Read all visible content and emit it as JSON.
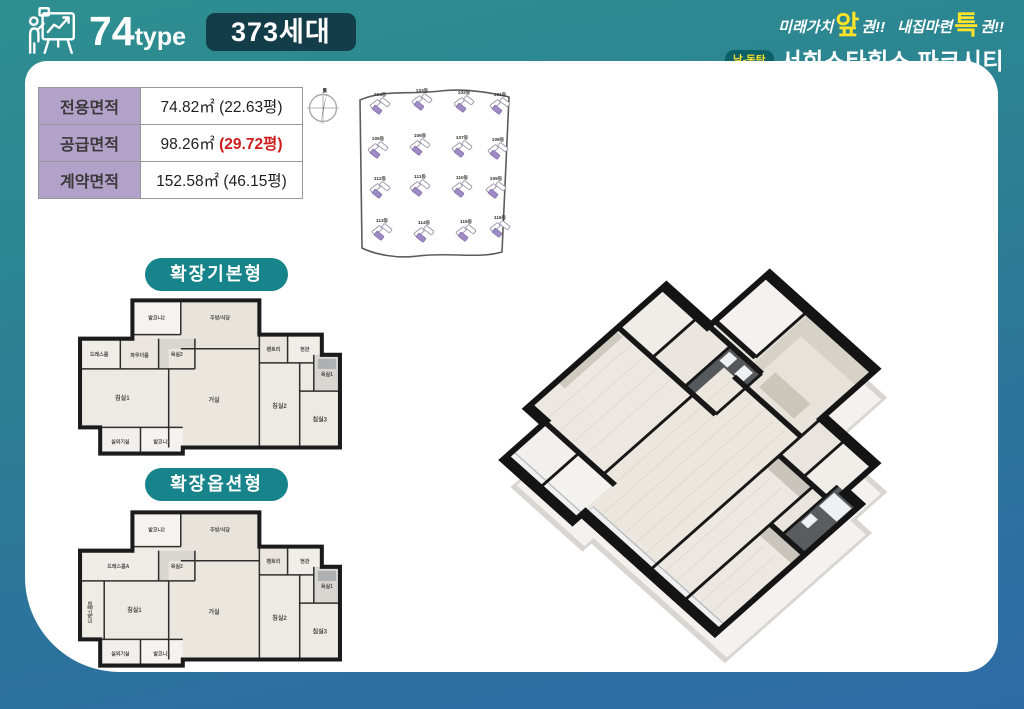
{
  "header": {
    "icon": "presentation-chart-icon",
    "type_number": "74",
    "type_suffix": "type",
    "units_badge": "373세대",
    "tagline": {
      "pre1": "미래가치",
      "big1": "앞",
      "post1": "권!!",
      "pre2": "내집마련",
      "big2": "특",
      "post2": "권!!"
    },
    "brand_badge": "남-동탄",
    "brand_name": "서희스타힐스 파크시티"
  },
  "area_table": {
    "rows": [
      {
        "label": "전용면적",
        "value": "74.82㎡",
        "pyeong": "(22.63평)"
      },
      {
        "label": "공급면적",
        "value": "98.26㎡",
        "pyeong": "(29.72평)"
      },
      {
        "label": "계약면적",
        "value": "152.58㎡",
        "pyeong": "(46.15평)"
      }
    ]
  },
  "site_plan": {
    "buildings": [
      [
        "104동",
        "103동",
        "102동",
        "101동"
      ],
      [
        "105동",
        "106동",
        "107동",
        "108동"
      ],
      [
        "112동",
        "111동",
        "110동",
        "109동"
      ],
      [
        "113동",
        "114동",
        "115동",
        "116동"
      ]
    ]
  },
  "plans": [
    {
      "title": "확장기본형",
      "rooms": [
        "발코니2",
        "주방/식당",
        "드레스룸",
        "파우더룸",
        "욕실2",
        "팬트리",
        "현관",
        "욕실1",
        "침실1",
        "거실",
        "침실2",
        "침실3",
        "실외기실",
        "발코니1"
      ]
    },
    {
      "title": "확장옵션형",
      "rooms": [
        "발코니2",
        "주방/식당",
        "드레스룸A",
        "욕실2",
        "팬트리",
        "현관",
        "욕실1",
        "드레스룸B",
        "침실1",
        "거실",
        "침실2",
        "침실3",
        "실외기실",
        "발코니1"
      ]
    }
  ],
  "colors": {
    "teal_top": "#2e8f90",
    "blue_bottom": "#2d6ba6",
    "badge_dark": "#133d48",
    "accent_yellow": "#ffe429",
    "table_purple": "#b2a1c9",
    "building_purple": "#9f8cc4",
    "pill_teal": "#17838a",
    "highlight_red": "#cf1d1d"
  }
}
